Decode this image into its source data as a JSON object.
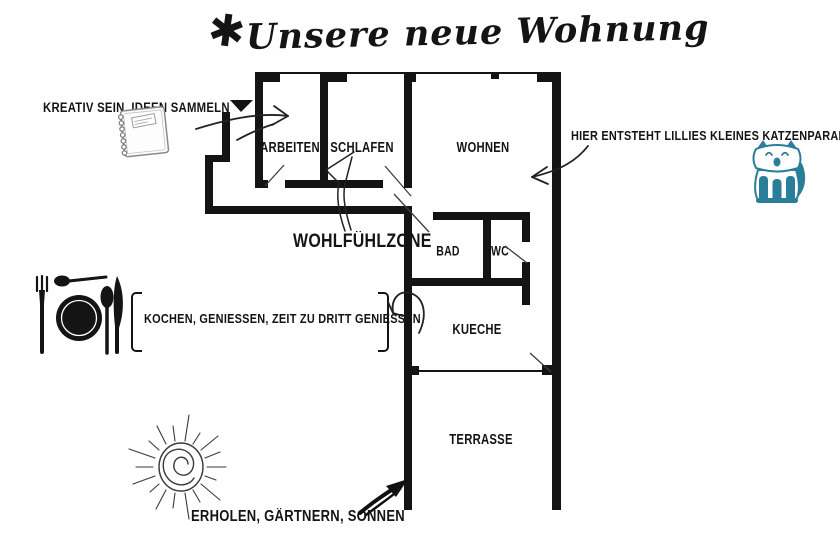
{
  "title": {
    "star": "✱",
    "text": "Unsere neue Wohnung"
  },
  "rooms": {
    "arbeiten": "ARBEITEN",
    "schlafen": "SCHLAFEN",
    "wohnen": "WOHNEN",
    "bad": "BAD",
    "wc": "WC",
    "kueche": "KUECHE",
    "terrasse": "TERRASSE"
  },
  "annotations": {
    "kreativ": "KREATIV SEIN, IDEEN SAMMELN",
    "katzenparadies": "HIER ENTSTEHT LILLIES KLEINES KATZENPARADIES",
    "wohlfuehlzone": "WOHLFÜHLZONE",
    "kochen": "KOCHEN, GENIESSEN, ZEIT ZU DRITT GENIESSEN",
    "erholen": "ERHOLEN, GÄRTNERN, SONNEN"
  },
  "icons": {
    "notebook": "notebook-icon",
    "place_setting": "place-setting-icon",
    "sun": "sun-icon",
    "cat": "cat-icon",
    "entrance_marker": "entrance-triangle-icon"
  },
  "colors": {
    "ink": "#141414",
    "cat_teal": "#2b7e99",
    "sketch_gray": "#8a8a8a"
  }
}
